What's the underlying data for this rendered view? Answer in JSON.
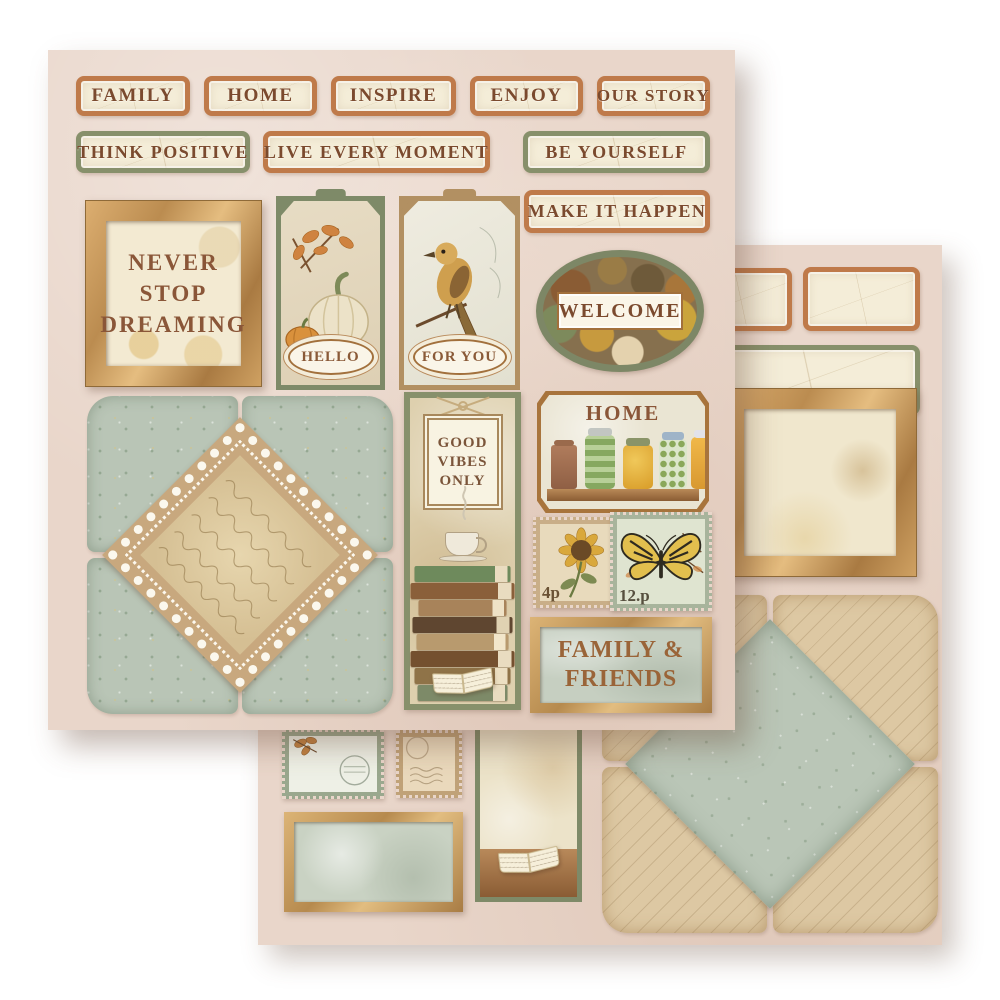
{
  "front_sheet": {
    "labels_row1": [
      {
        "text": "FAMILY",
        "border": "orange"
      },
      {
        "text": "HOME",
        "border": "orange"
      },
      {
        "text": "INSPIRE",
        "border": "orange"
      },
      {
        "text": "ENJOY",
        "border": "orange"
      },
      {
        "text": "OUR STORY",
        "border": "orange"
      }
    ],
    "labels_row2": [
      {
        "text": "THINK POSITIVE",
        "border": "green"
      },
      {
        "text": "LIVE EVERY MOMENT",
        "border": "orange"
      },
      {
        "text": "BE YOURSELF",
        "border": "green"
      }
    ],
    "label_make_it_happen": {
      "text": "MAKE IT HAPPEN",
      "border": "orange"
    },
    "framed_quote": {
      "line1": "NEVER",
      "line2": "STOP",
      "line3": "DREAMING"
    },
    "pumpkin_tag": {
      "label": "HELLO"
    },
    "bird_tag": {
      "label": "FOR YOU"
    },
    "welcome_plaque": {
      "label": "WELCOME"
    },
    "good_vibes_tag": {
      "line1": "GOOD",
      "line2": "VIBES",
      "line3": "ONLY"
    },
    "home_shelf": {
      "label": "HOME"
    },
    "stamp_sunflower": {
      "denomination": "4p"
    },
    "stamp_butterfly": {
      "denomination": "12.p"
    },
    "family_friends_frame": {
      "line1": "FAMILY &",
      "line2": "FRIENDS"
    }
  },
  "back_sheet": {
    "blank_labels": [
      "orange",
      "orange",
      "green"
    ],
    "empty_frames": [
      "wood",
      "gold"
    ],
    "blank_stamps": [
      "green",
      "tan"
    ]
  },
  "palette": {
    "sheet_base": "#e9d6ca",
    "label_cream": "#f4edd8",
    "border_orange": "#bf7a4a",
    "border_green": "#87906b",
    "text_brown": "#7b4a2e",
    "wood_light": "#dcae70",
    "wood_dark": "#a97a42",
    "envelope_sage": "#b9c5b6",
    "script_tan": "#ddc8a3",
    "lace_white": "#fbf8ee"
  }
}
